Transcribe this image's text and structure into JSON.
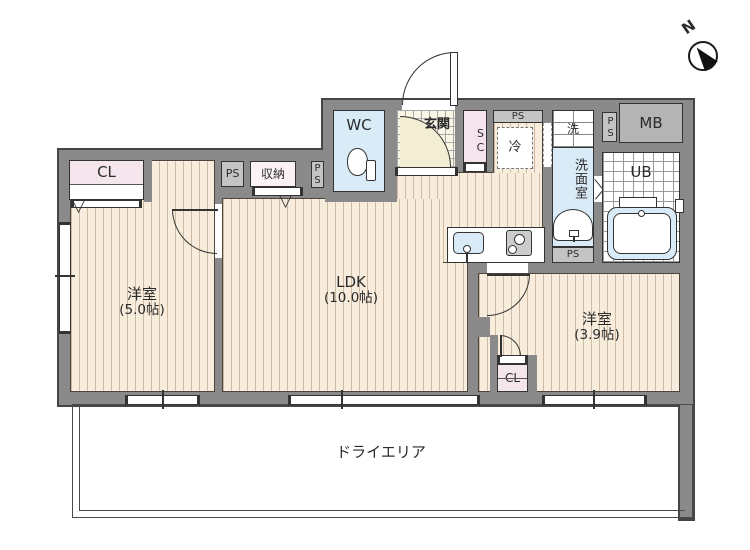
{
  "compass": {
    "north_label": "N"
  },
  "rooms": {
    "bedroom_west": {
      "name": "洋室",
      "size": "(5.0帖)"
    },
    "ldk": {
      "name": "LDK",
      "size": "(10.0帖)"
    },
    "bedroom_east": {
      "name": "洋室",
      "size": "(3.9帖)"
    },
    "dry_area": {
      "name": "ドライエリア"
    },
    "wc": {
      "name": "WC"
    },
    "entrance": {
      "name": "玄関"
    },
    "shoe_closet": {
      "name": "SC"
    },
    "storage": {
      "name": "収納"
    },
    "closet_west": {
      "name": "CL"
    },
    "closet_east": {
      "name": "CL"
    },
    "refrigerator_space": {
      "name": "冷"
    },
    "washer_space": {
      "name": "洗"
    },
    "washroom": {
      "name": "洗面室"
    },
    "unit_bath": {
      "name": "UB"
    },
    "meter_box": {
      "name": "MB"
    },
    "pipe_space": {
      "name": "PS"
    }
  },
  "colors": {
    "wall": "#8a8a8a",
    "wall_outline": "#454545",
    "floor": "#f8ecdc",
    "floor_stripe": "#cfbaa3",
    "water_blue": "#d9ebf7",
    "closet_pink": "#f5e6ee",
    "entrance_tile": "#faf6e6",
    "hall_cream": "#f3edd3",
    "service_gray": "#c4c4c4",
    "meter_gray": "#b4b4b4"
  }
}
